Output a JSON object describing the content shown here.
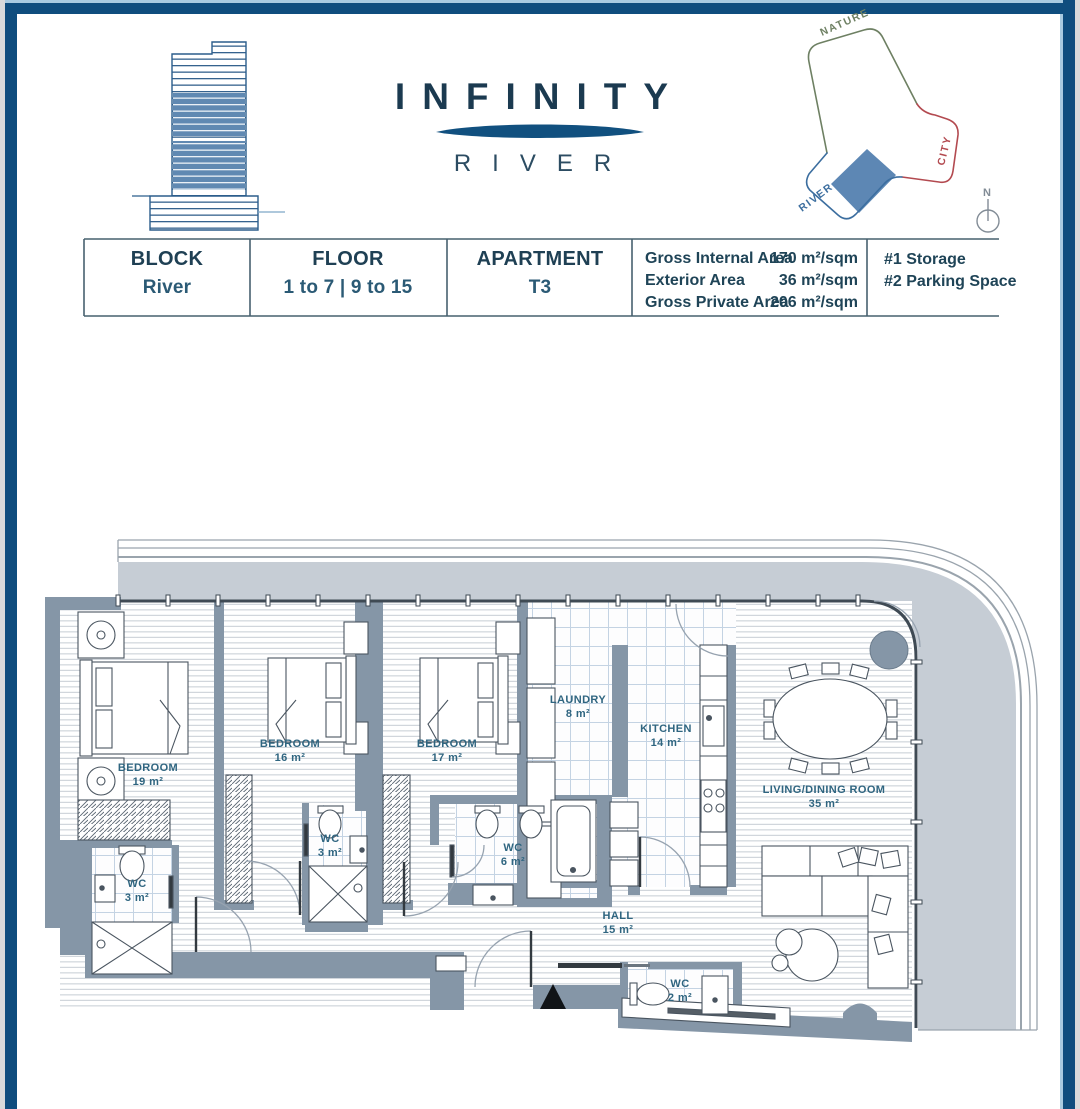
{
  "header": {
    "brand": {
      "title": "INFINITY",
      "subtitle": "RIVER"
    },
    "orientation": {
      "nature": "NATURE",
      "city": "CITY",
      "river": "RIVER",
      "compass_n": "N"
    }
  },
  "spec_table": {
    "block": {
      "label": "BLOCK",
      "value": "River"
    },
    "floor": {
      "label": "FLOOR",
      "value": "1 to 7 | 9 to 15"
    },
    "apartment": {
      "label": "APARTMENT",
      "value": "T3"
    },
    "areas": [
      {
        "label": "Gross Internal Area",
        "value": "170 m²/sqm"
      },
      {
        "label": "Exterior Area",
        "value": "36 m²/sqm"
      },
      {
        "label": "Gross Private Area",
        "value": "206 m²/sqm"
      }
    ],
    "extras": [
      {
        "label": "#1 Storage"
      },
      {
        "label": "#2 Parking Space"
      }
    ]
  },
  "plan": {
    "rooms": [
      {
        "name": "BEDROOM",
        "area": "19 m²"
      },
      {
        "name": "BEDROOM",
        "area": "16 m²"
      },
      {
        "name": "BEDROOM",
        "area": "17 m²"
      },
      {
        "name": "LAUNDRY",
        "area": "8 m²"
      },
      {
        "name": "KITCHEN",
        "area": "14 m²"
      },
      {
        "name": "LIVING/DINING ROOM",
        "area": "35 m²"
      },
      {
        "name": "WC",
        "area": "3 m²"
      },
      {
        "name": "WC",
        "area": "3 m²"
      },
      {
        "name": "WC",
        "area": "6 m²"
      },
      {
        "name": "HALL",
        "area": "15 m²"
      },
      {
        "name": "WC",
        "area": "2 m²"
      }
    ]
  },
  "colors": {
    "frame_navy": "#0f4d7e",
    "frame_accent": "#a9cbe1",
    "wall": "#8596a7",
    "terrace": "#c6cdd5",
    "label_text": "#2f6580",
    "nature_green": "#6e8063",
    "city_red": "#b34a50",
    "river_blue": "#3c6e9f",
    "highlight_blue": "#5d87b4"
  }
}
